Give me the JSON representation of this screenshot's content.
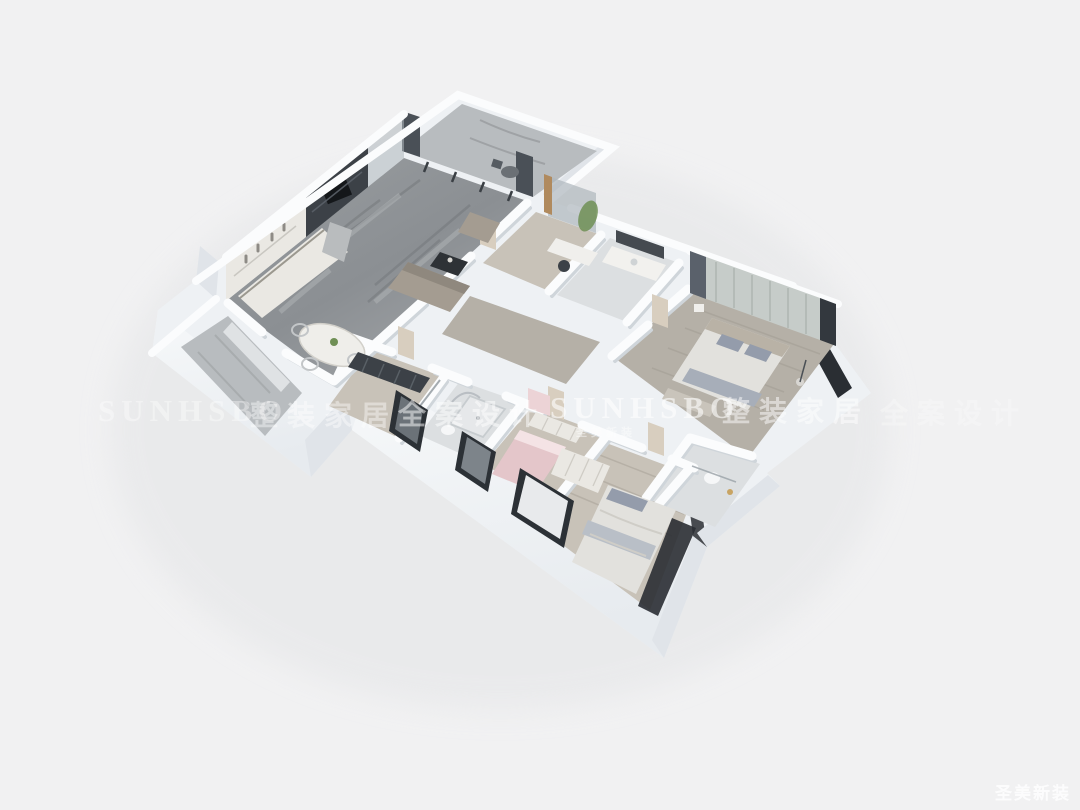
{
  "image": {
    "kind": "3d-floorplan-render",
    "alt": "Isometric 3D cutaway render of a three-bedroom apartment: open living-dining-kitchen wing with gray marble floor at top left, glazed balcony at the tip, study and bathrooms in the middle, master bedroom at right, two more bedrooms and bathrooms in the lower wing, empty utility balcony at far left",
    "background": "#f1f1f2"
  },
  "palette": {
    "bg": "#f1f1f2",
    "wall-top": "#fbfcfd",
    "wall-bright": "#f5f7f9",
    "wall-light": "#eef1f4",
    "wall-mid": "#e0e4e9",
    "wall-shade": "#cfd5da",
    "wall-dark": "#2a2e33",
    "floor-marble": "#8f9396",
    "floor-marble-light": "#b8bcbf",
    "floor-wood": "#b5b0a7",
    "floor-wood-light": "#c8c2b8",
    "floor-tile": "#dcdfe1",
    "cabinet-light": "#eae8e3",
    "furniture-dark": "#3c4147",
    "sofa-taupe": "#a49c91",
    "bed-linen": "#e2e1dd",
    "pillow-gray": "#949cab",
    "bed-pink": "#e4c6ca",
    "plant-green": "#6f8f55",
    "wood-accent": "#b08a5e",
    "glass": "#aeb6bc",
    "watermark": "#ffffff"
  },
  "watermarks": {
    "row": [
      {
        "text": "SUNHSBO"
      },
      {
        "text": "整装家居"
      },
      {
        "text": "全案设计"
      },
      {
        "text": "SUNHSBO",
        "subtext": "圣美新装"
      },
      {
        "text": "整装家居"
      },
      {
        "text": "全案设计"
      }
    ],
    "corner": {
      "text": "圣美新装"
    }
  }
}
